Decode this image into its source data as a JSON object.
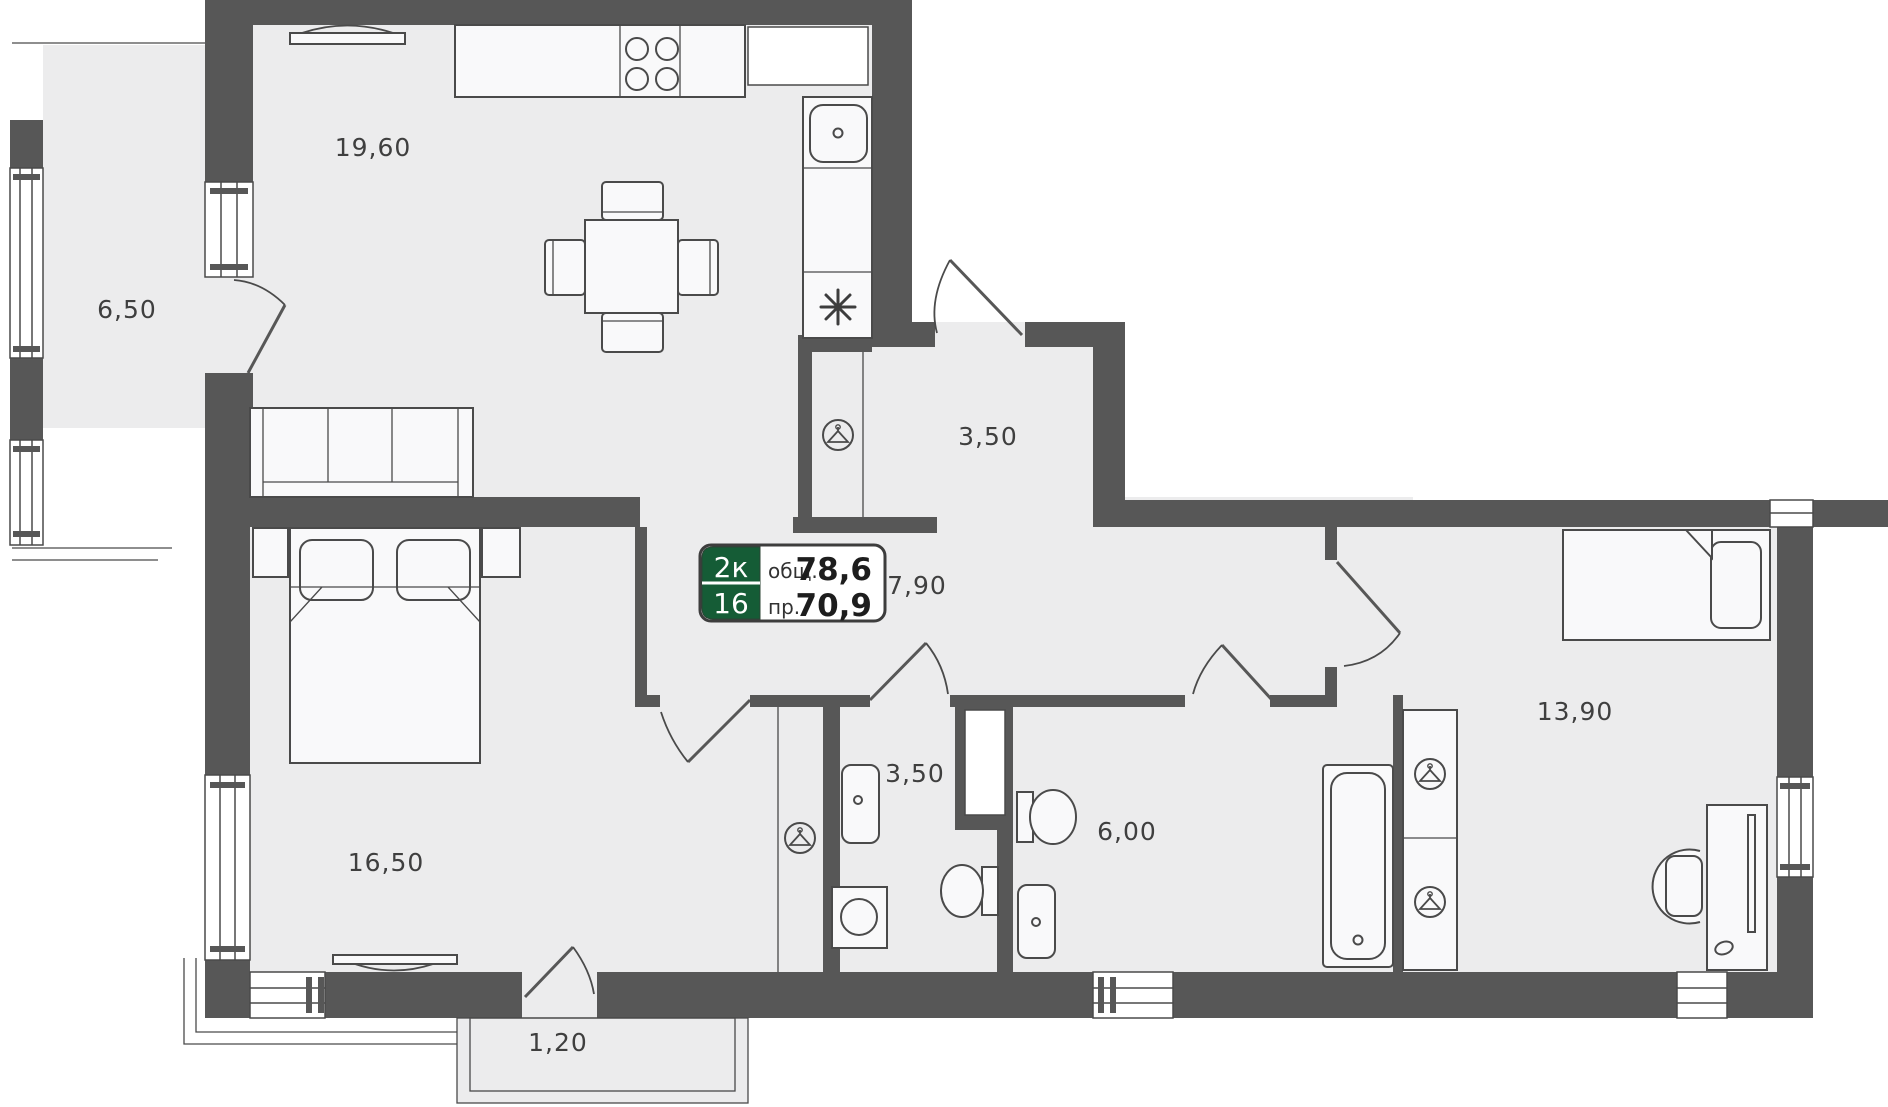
{
  "badge": {
    "type_code": "2к",
    "floor": "16",
    "total_label": "общ.",
    "total_value": "78,6",
    "living_label": "пр.",
    "living_value": "70,9"
  },
  "rooms": {
    "kitchen_living": {
      "area": "19,60"
    },
    "balcony_left": {
      "area": "6,50"
    },
    "entry_hall": {
      "area": "3,50"
    },
    "corridor": {
      "area": "7,90"
    },
    "bedroom_right": {
      "area": "13,90"
    },
    "bedroom_left": {
      "area": "16,50"
    },
    "bathroom_small": {
      "area": "3,50"
    },
    "bathroom_large": {
      "area": "6,00"
    },
    "balcony_bottom": {
      "area": "1,20"
    }
  },
  "icons": {
    "wardrobe": "hanger-in-circle",
    "freezer": "snowflake-asterisk"
  },
  "colors": {
    "wall": "#575757",
    "room_fill": "#ececed",
    "furniture_fill": "#f9f9fa",
    "line": "#4a4a4a",
    "label_text": "#3f3f3f",
    "badge_green": "#155c36"
  }
}
